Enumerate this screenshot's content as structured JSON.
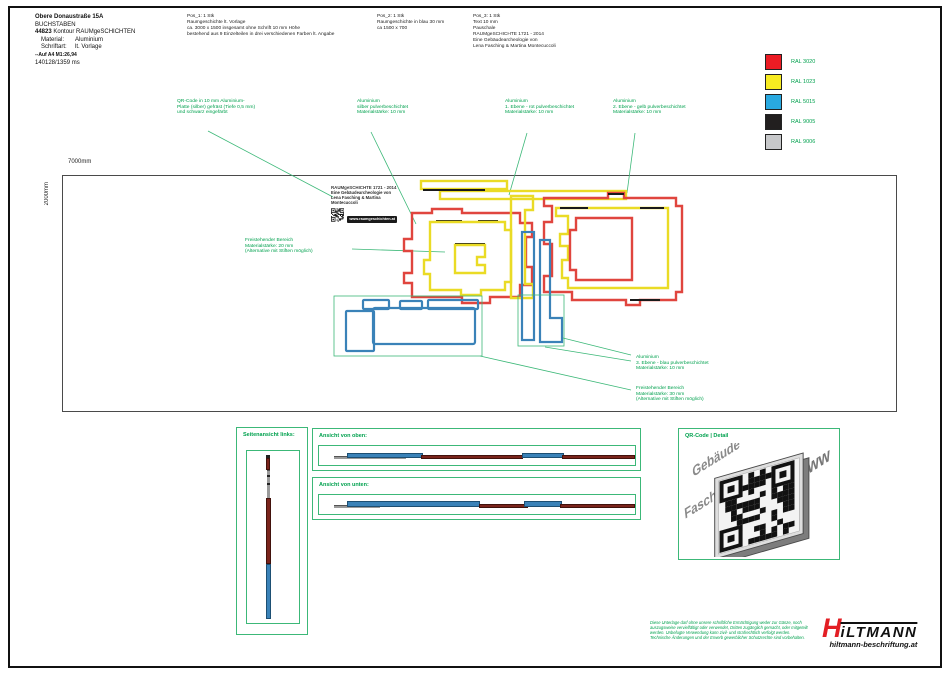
{
  "header": {
    "line1": "Obere Donaustraße 15A",
    "line2": "BUCHSTABEN",
    "order_no": "44823",
    "order_rest": "Kontour RAUMgeSCHICHTEN",
    "material_label": "Material:",
    "material_value": "Aluminium",
    "schriftart_label": "Schriftart:",
    "schriftart_value": "lt. Vorlage",
    "scale_note": "--Auf A4 M1:26,94",
    "job_ref": "140128/1359 ms"
  },
  "positions": [
    {
      "title": "Pos_1: 1 Stk",
      "lines": [
        "Raumgeschichte lt. Vorlage",
        "ca. 3000 x 1500 insgesamt ohne Schrift 10 mm Höhe",
        "bestehend aus 9 Einzelteilen in drei verschiedenen Farben lt. Angabe"
      ]
    },
    {
      "title": "Pos_2: 1 Stk",
      "lines": [
        "Raumgeschichte in blau 30 mm",
        "ca 1500 x 700"
      ]
    },
    {
      "title": "Pos_3: 1 Stk",
      "lines": [
        "Text 10 mm",
        "Pauschale",
        "RAUMgeSCHICHTE 1721 - 2014",
        "Eine Gebäudearcheologie von",
        "Lena Fasching & Martina Montecuccoli"
      ]
    }
  ],
  "legend": {
    "items": [
      {
        "label": "RAL 3020",
        "color": "#EC1C24"
      },
      {
        "label": "RAL 1023",
        "color": "#F7EB21"
      },
      {
        "label": "RAL 5015",
        "color": "#29A9E0"
      },
      {
        "label": "RAL 9005",
        "color": "#221F1F"
      },
      {
        "label": "RAL 9006",
        "color": "#C7C8CA"
      }
    ]
  },
  "annotations": {
    "qr": {
      "lines": [
        "QR-Code in 10 mm Aluminium-",
        "Platte (silber) gefräst (Tiefe 0,5 mm)",
        "und schwarz eingefärbt"
      ]
    },
    "alu_silver": {
      "lines": [
        "Aluminium",
        "silber pulverbeschichtet",
        "Materialstärke: 10 mm"
      ]
    },
    "alu_red": {
      "lines": [
        "Aluminium",
        "1. Ebene - rot pulverbeschichtet",
        "Materialstärke: 10 mm"
      ]
    },
    "alu_yellow": {
      "lines": [
        "Aluminium",
        "2. Ebene - gelb pulverbeschichtet",
        "Materialstärke: 10 mm"
      ]
    },
    "free20": {
      "lines": [
        "Freistehender Bereich",
        "Materialstärke: 20 mm",
        "(Alternative mit Stiften möglich)"
      ]
    },
    "alu_blue": {
      "lines": [
        "Aluminium",
        "3. Ebene - blau pulverbeschichtet",
        "Materialstärke: 10 mm"
      ]
    },
    "free30": {
      "lines": [
        "Freistehender Bereich",
        "Materialstärke: 30 mm",
        "(Alternative mit Stiften möglich)"
      ]
    }
  },
  "drawing": {
    "width_label": "7000mm",
    "height_label": "2000mm",
    "qr_block": {
      "title": "RAUMgeSCHICHTE 1721 - 2014",
      "line2": "Eine Gebäudearcheologie von",
      "line3": "Lena Fasching & Martina Montecuccoli",
      "url": "www.raumgeschichten.at"
    }
  },
  "panels": {
    "side": {
      "label": "Seitenansicht links:"
    },
    "top": {
      "label": "Ansicht von oben:"
    },
    "bottom": {
      "label": "Ansicht von unten:"
    },
    "qr": {
      "label": "QR-Code | Detail",
      "deco1": "Gebäude",
      "deco2": "Fasching",
      "deco3": "www"
    }
  },
  "footer": {
    "disclaimer": [
      "Diese Unterlage darf ohne unsere schriftliche Ermächtigung weder zur Gänze, noch",
      "auszugsweise vervielfältigt oder verwendet, Dritten zugänglich gemacht, oder mitgeteilt",
      "werden. Unbefugte Verwendung kann zivil- und strafrechtlich verfolgt werden.",
      "Technische Änderungen und der Erwerb gewerblicher Schutzrechte sind vorbehalten."
    ],
    "logo_h": "H",
    "logo_rest": "iLTMANN",
    "logo_url": "hiltmann-beschriftung.at"
  },
  "colors": {
    "ann_green": "#00A14E",
    "box_green": "#3CB878",
    "art_red": "#E0453E",
    "art_yellow": "#EADB25",
    "art_black": "#1A1A1A",
    "steel": "#3A82B8",
    "dark_red": "#7A241C",
    "bar_gray": "#9A9A9A",
    "logo_red": "#E31E24"
  }
}
